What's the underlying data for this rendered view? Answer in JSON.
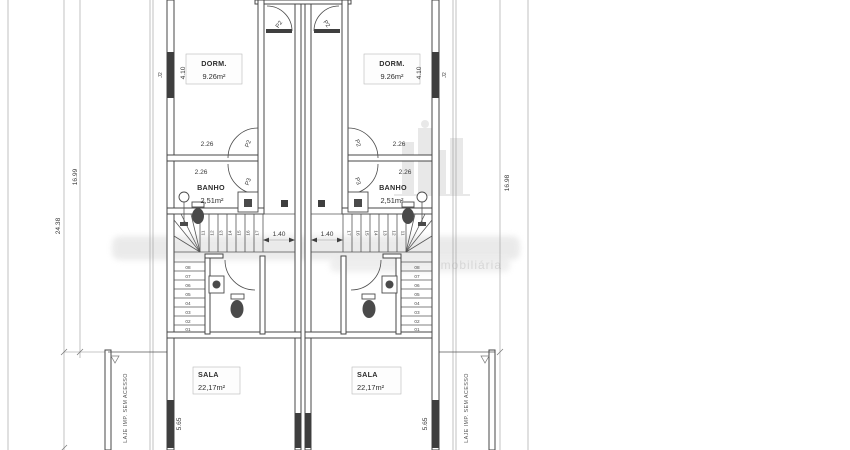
{
  "rooms": {
    "dorm": {
      "name": "DORM.",
      "area": "9.26m²"
    },
    "banho": {
      "name": "BANHO",
      "area": "2,51m²"
    },
    "sala": {
      "name": "SALA",
      "area": "22,17m²"
    }
  },
  "doors": {
    "p2": "P2",
    "p3": "P3"
  },
  "windows": {
    "dorm_window": "J2"
  },
  "dimensions": {
    "total_height_left": "24.38",
    "inner_height_left": "16.99",
    "inner_height_right": "16.98",
    "dorm_length": "4.10",
    "dorm_width": "2.26",
    "banho_width": "2.26",
    "stair_landing_width": "1.40",
    "sala_length": "5.65"
  },
  "stairs": {
    "upper_left": [
      "11",
      "12",
      "13",
      "14",
      "15",
      "16",
      "17"
    ],
    "upper_right": [
      "17",
      "16",
      "15",
      "14",
      "13",
      "12",
      "11"
    ],
    "lower": [
      "08",
      "07",
      "06",
      "05",
      "04",
      "03",
      "02",
      "01"
    ]
  },
  "annotations": {
    "laje": "LAJE IMP. SEM ACESSO"
  },
  "watermark": {
    "text": "imobiliária"
  }
}
